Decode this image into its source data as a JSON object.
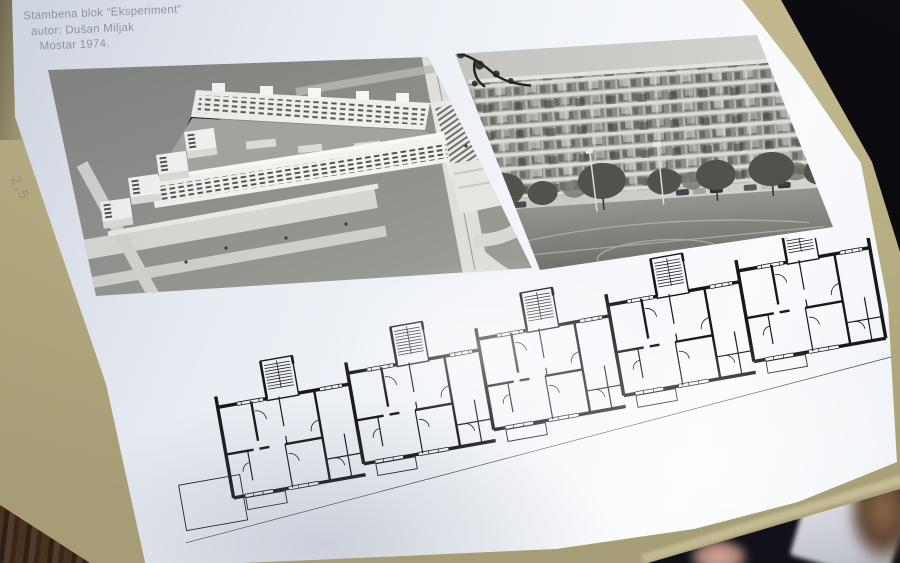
{
  "poster": {
    "caption": {
      "line1": "Stambena blok “Eksperiment”",
      "line2": "autor: Dušan Miljak",
      "line3": "Mostar 1974."
    }
  },
  "surface": {
    "pencil_note": "2,5"
  },
  "colors": {
    "poster_paper": "#eef2f7",
    "cardboard": "#b6ac83",
    "photo_gray": "#8b8b87",
    "plan_ink": "#17181c",
    "caption_text": "#8f95a0",
    "background_black": "#0a090c",
    "bottom_void": "#14151d"
  }
}
